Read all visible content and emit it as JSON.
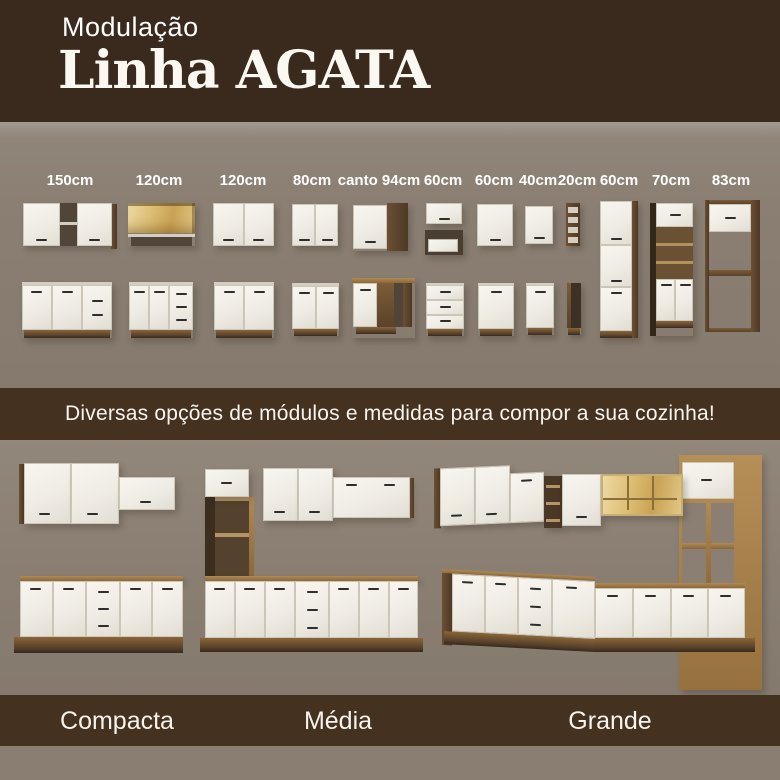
{
  "header": {
    "kicker": "Modulação",
    "title": "Linha AGATA"
  },
  "modules": {
    "sizes": [
      "150cm",
      "120cm",
      "120cm",
      "80cm",
      "canto 94cm",
      "60cm",
      "60cm",
      "40cm",
      "20cm",
      "60cm",
      "70cm",
      "83cm"
    ]
  },
  "banner": {
    "text": "Diversas opções de módulos e medidas para compor a sua cozinha!"
  },
  "kitchens": {
    "labels": [
      "Compacta",
      "Média",
      "Grande"
    ]
  },
  "colors": {
    "header_bg": "#3a2a1e",
    "band_bg": "#44311f",
    "section_bg": "#8b7f73",
    "door_white": "#f4f1ea",
    "wood_dark": "#5a4330",
    "wood_oak": "#a07a48",
    "gold": "#d9b969",
    "text_white": "#ffffff"
  }
}
